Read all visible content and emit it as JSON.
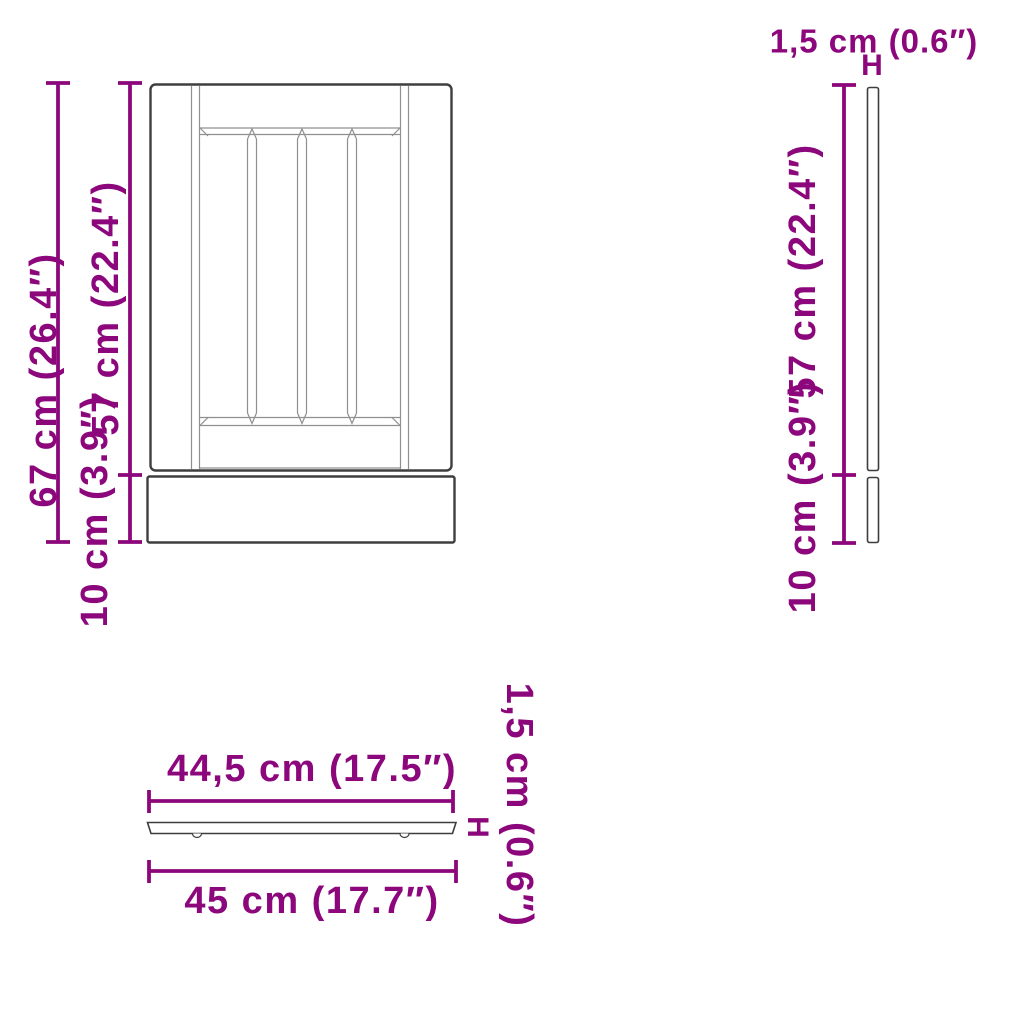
{
  "diagram": {
    "title": "cabinet-panel-dimension-diagram",
    "colors": {
      "dimension": "#8C077C",
      "outline": "#3E3E3E",
      "inner_line": "#8F8F8F",
      "background": "#FFFFFF"
    },
    "views": {
      "front": {
        "height_total": "67 cm (26.4″)",
        "height_door": "57 cm (22.4″)",
        "height_plinth": "10 cm (3.9″)"
      },
      "side": {
        "thickness": "1,5 cm (0.6″)",
        "thickness_marker": "H",
        "height_door": "57 cm (22.4″)",
        "height_plinth": "10 cm (3.9″)"
      },
      "top": {
        "width_inner": "44,5 cm (17.5″)",
        "width_total": "45 cm (17.7″)",
        "thickness": "1,5 cm (0.6″)",
        "thickness_marker": "H"
      }
    }
  }
}
